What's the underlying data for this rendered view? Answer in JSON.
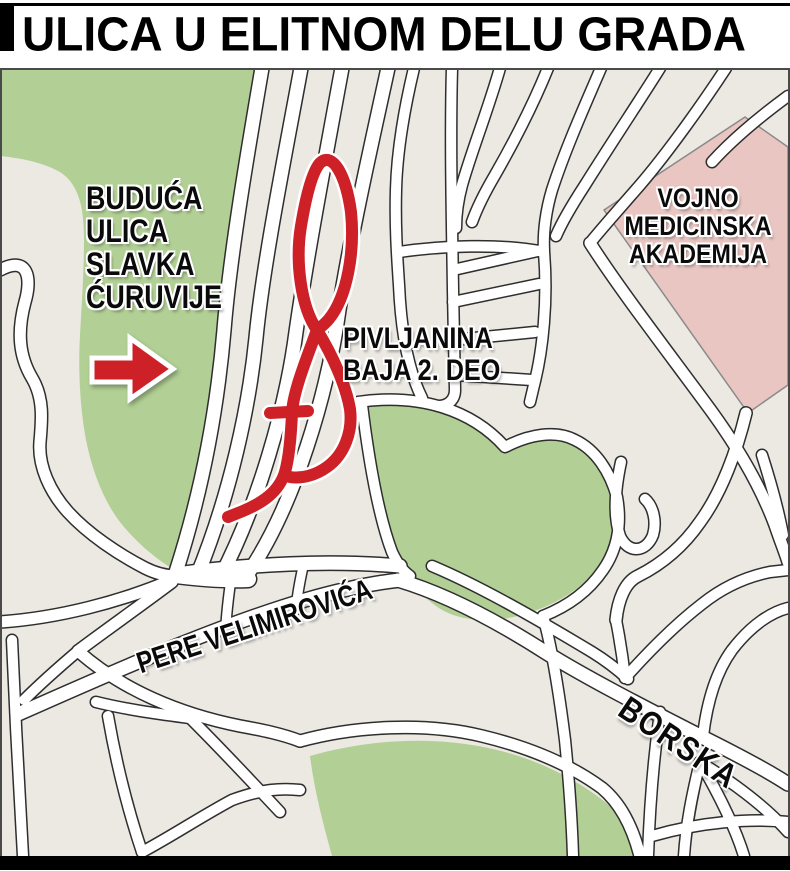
{
  "header": {
    "title": "ULICA U ELITNOM DELU GRADA"
  },
  "map": {
    "labels": {
      "future_street": "BUDUĆA\nULICA\nSLAVKA\nĆURUVIJE",
      "pivljanina": "PIVLJANINA\nBAJA 2. DEO",
      "vma": "VOJNO\nMEDICINSKA\nAKADEMIJA",
      "pere": "PERE VELIMIROVIĆA",
      "borska": "BORSKA"
    },
    "icons": {
      "direction_arrow": "red-right-arrow"
    },
    "colors": {
      "background": "#ffffff",
      "land": "#ece9e3",
      "green_area": "#b2d095",
      "building_pink": "#e9c6c1",
      "road_fill": "#ffffff",
      "road_casing": "#2e2e2e",
      "highlight_red": "#cd2127",
      "frame": "#4a4a4a",
      "title_black": "#000000"
    }
  }
}
